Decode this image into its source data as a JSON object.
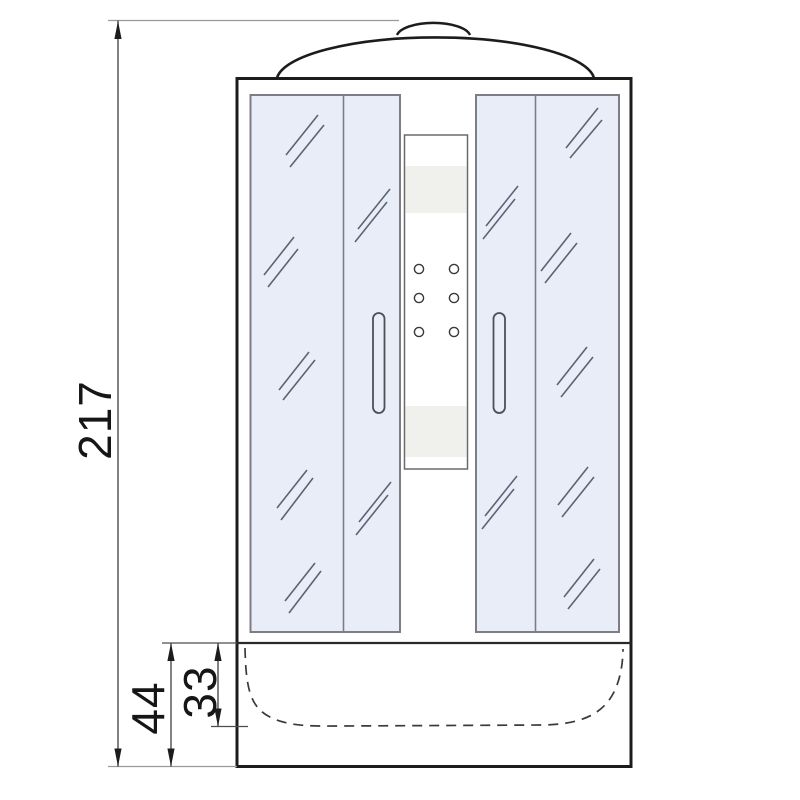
{
  "dimensions": {
    "total_height": "217",
    "base_height": "44",
    "tray_inner_height": "33"
  },
  "colors": {
    "background": "#ffffff",
    "outline": "#1c1c1c",
    "glass_fill": "#e9edf8",
    "panel_border": "#7d7d86",
    "column_band": "#f0f0ec",
    "dimension_line": "#4d4d4d",
    "extension_line": "#9a9a9a",
    "reflection_mark": "#5a6475"
  }
}
